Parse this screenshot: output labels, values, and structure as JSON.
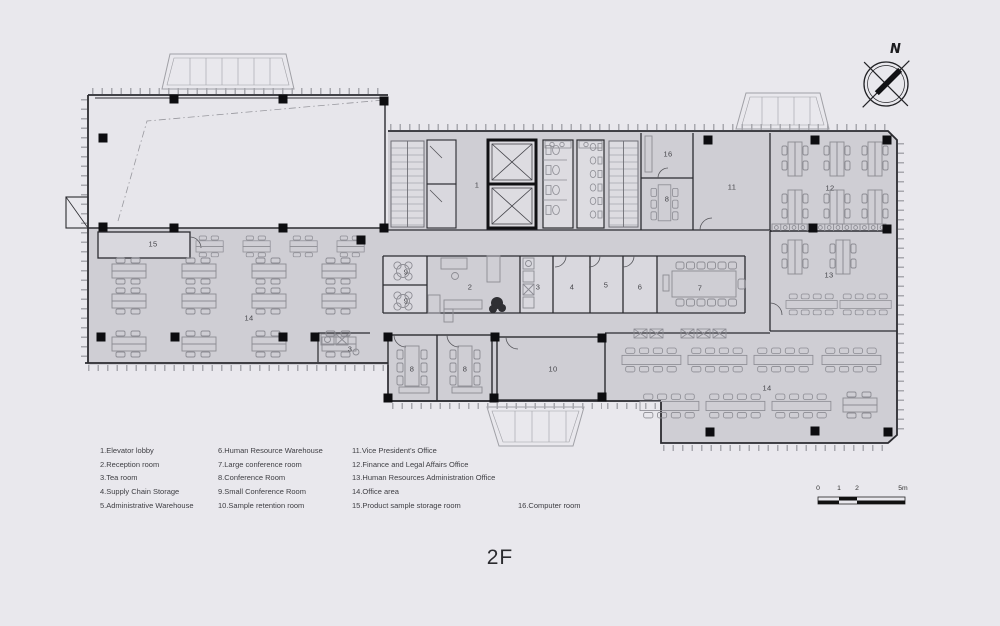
{
  "title": "2F",
  "compass": {
    "label": "N"
  },
  "scale_bar": {
    "ticks": [
      "0",
      "1",
      "2",
      "5m"
    ]
  },
  "rooms": {
    "1": "1",
    "2": "2",
    "3": "3",
    "4": "4",
    "5": "5",
    "6": "6",
    "7": "7",
    "8": "8",
    "9": "9",
    "10": "10",
    "11": "11",
    "12": "12",
    "13": "13",
    "14": "14",
    "15": "15",
    "16": "16"
  },
  "legend": {
    "columns": [
      {
        "items": [
          "1.Elevator lobby",
          "2.Reception room",
          "3.Tea room",
          "4.Supply Chain Storage",
          "5.Administrative Warehouse"
        ]
      },
      {
        "items": [
          "6.Human Resource Warehouse",
          "7.Large conference room",
          "8.Conference Room",
          "9.Small Conference Room",
          "10.Sample retention room"
        ]
      },
      {
        "items": [
          "11.Vice President's Office",
          "12.Finance and Legal Affairs Office",
          "13.Human Resources Administration Office",
          "14.Office area",
          "15.Product sample storage room"
        ]
      },
      {
        "items": [
          "16.Computer room"
        ]
      }
    ]
  },
  "colors": {
    "background": "#e9e8ed",
    "floor": "#cfced4",
    "room_light": "#d9d8de",
    "void": "#e7e6eb",
    "wall": "#2b2b30",
    "column": "#0d0d10",
    "furniture": "#8c8c93"
  }
}
